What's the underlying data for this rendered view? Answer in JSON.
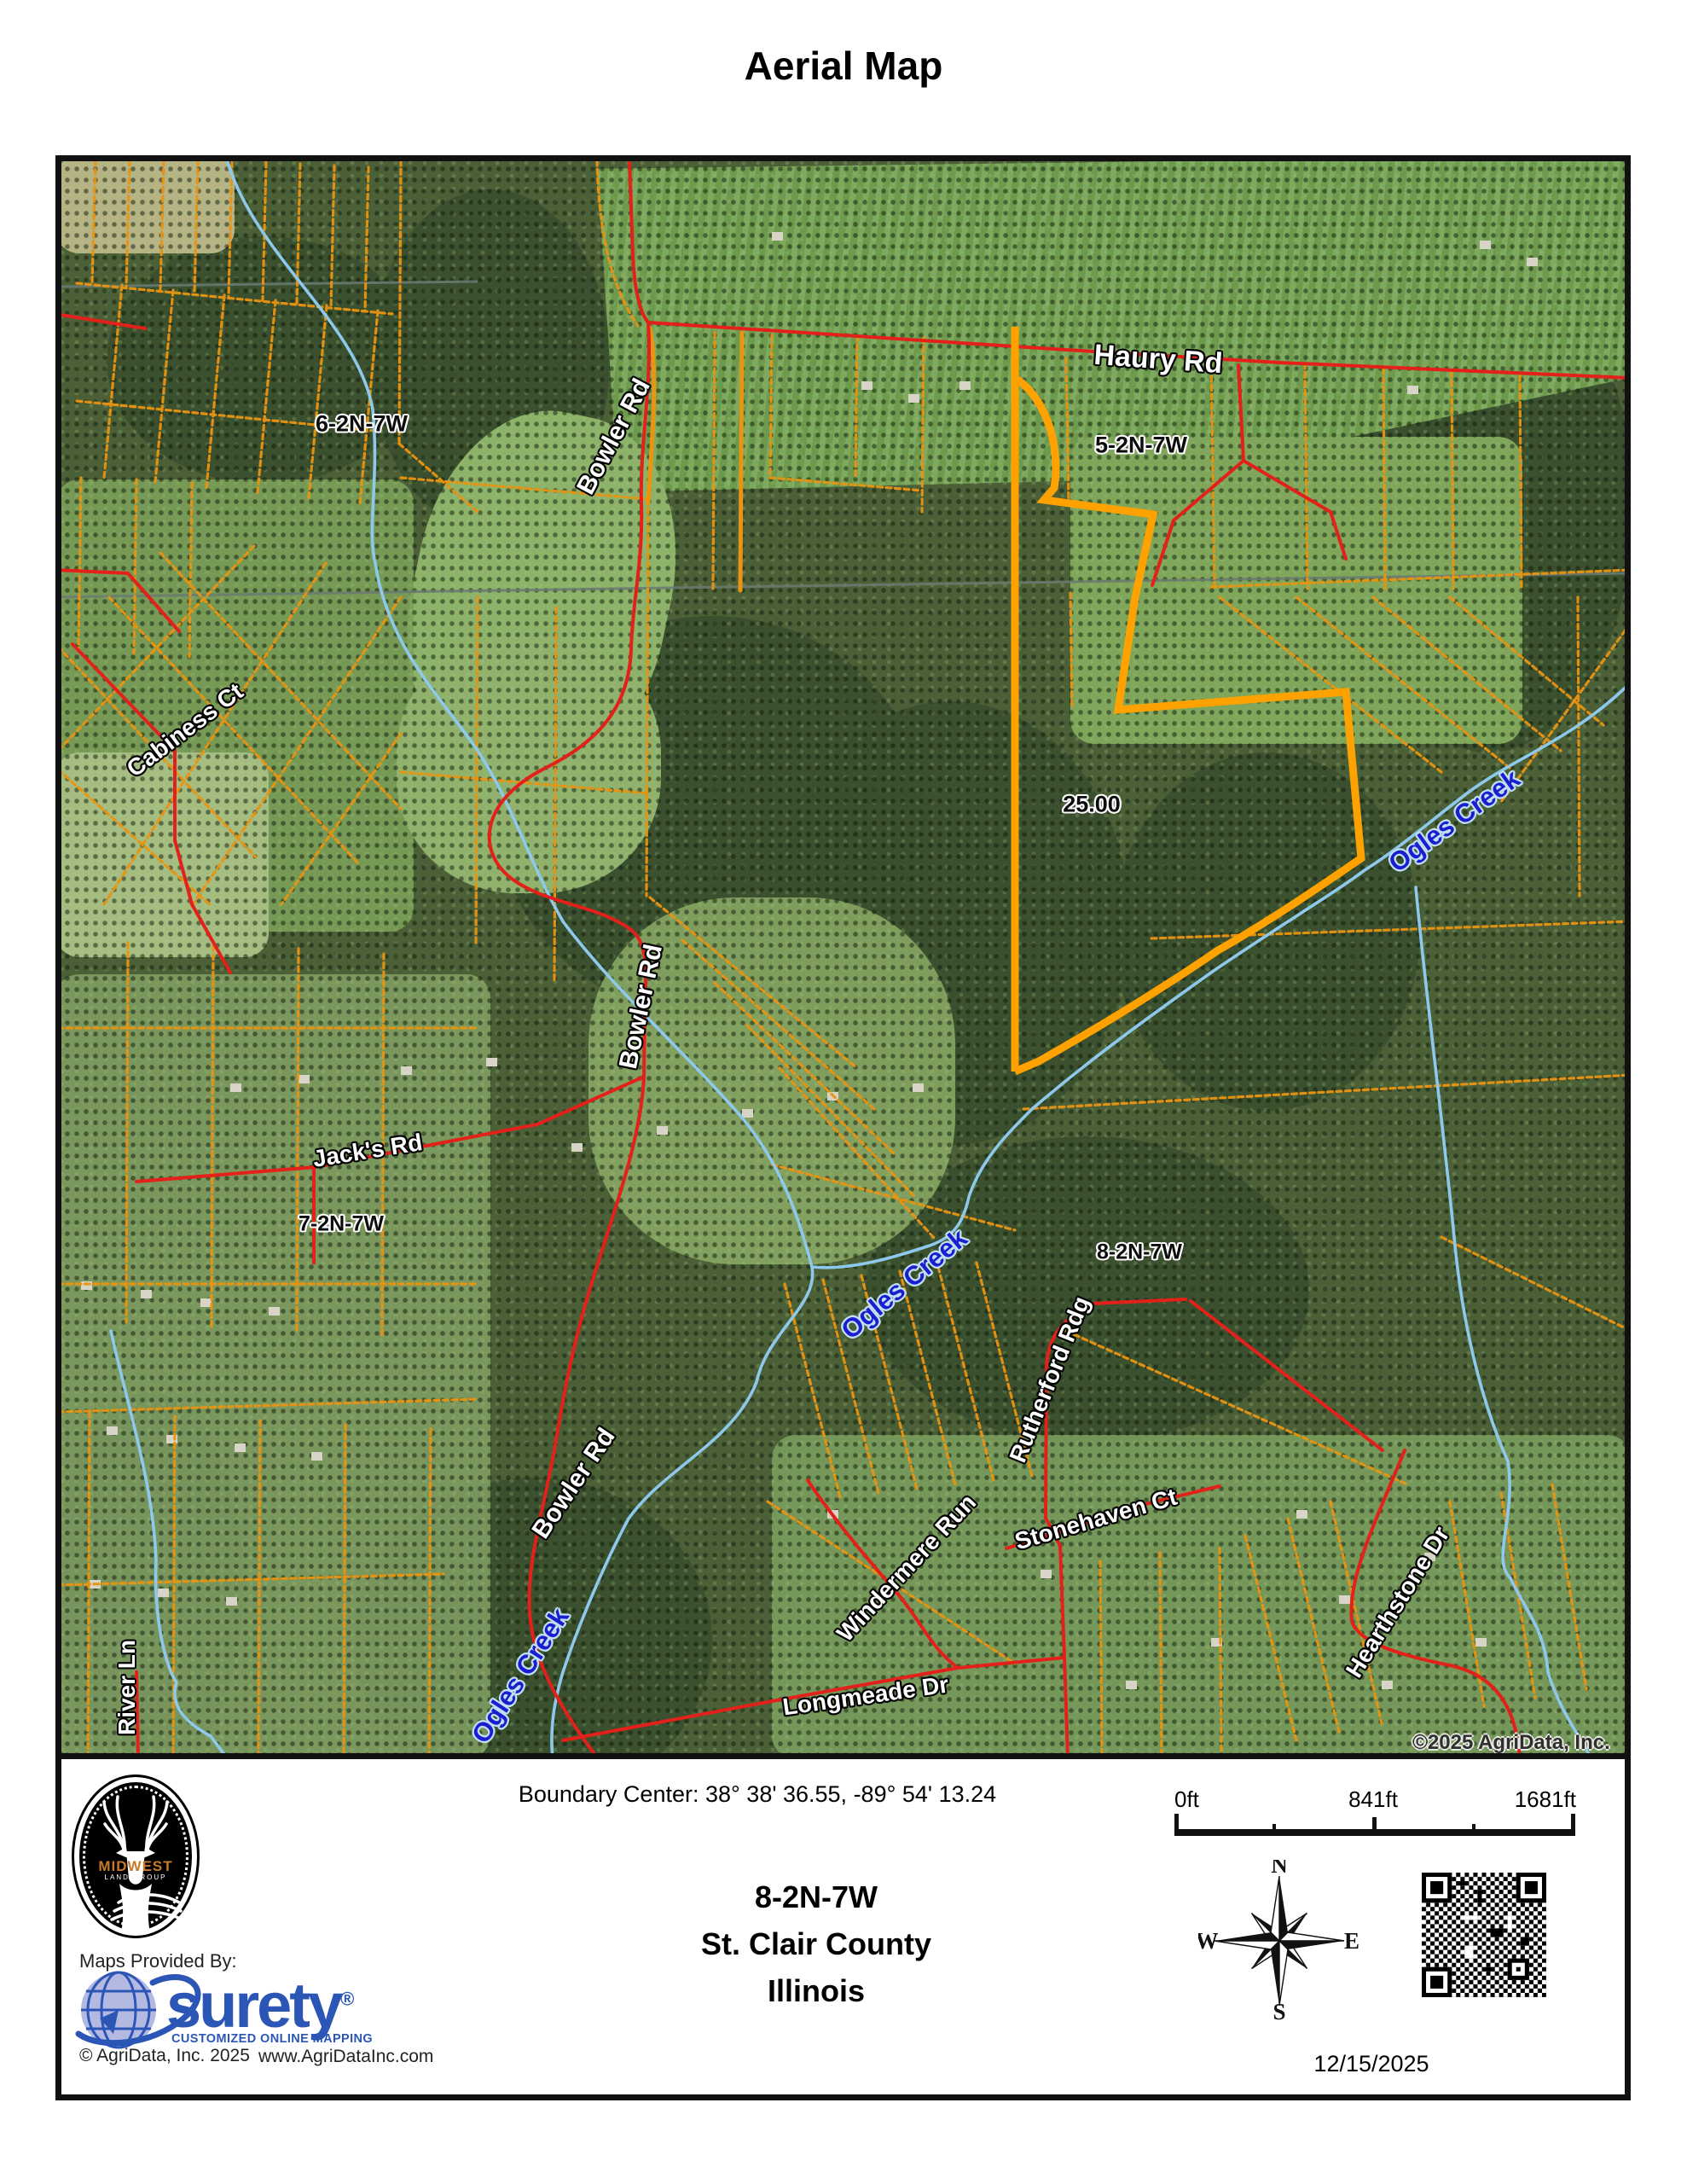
{
  "page": {
    "title": "Aerial Map"
  },
  "map": {
    "labels": {
      "haury_rd": "Haury Rd",
      "region_6": "6-2N-7W",
      "bowler_rd_top": "Bowler Rd",
      "region_5": "5-2N-7W",
      "cabiness_ct": "Cabiness Ct",
      "parcel_acreage": "25.00",
      "ogles_creek_right": "Ogles Creek",
      "bowler_rd_mid": "Bowler Rd",
      "jacks_rd": "Jack's Rd",
      "region_7": "7-2N-7W",
      "ogles_creek_mid": "Ogles Creek",
      "region_8": "8-2N-7W",
      "rutherford_rdg": "Rutherford Rdg",
      "bowler_rd_low": "Bowler Rd",
      "windermere_run": "Windermere Run",
      "stonehaven_ct": "Stonehaven Ct",
      "hearthstone_dr": "Hearthstone Dr",
      "ogles_creek_low": "Ogles Creek",
      "longmeade_dr": "Longmeade Dr",
      "river_ln": "River Ln",
      "watermark": "©2025 AgriData, Inc."
    },
    "colors": {
      "parcel_line": "#ea9410",
      "selected_parcel": "#ffa200",
      "road": "#e3211a",
      "creek": "#8ec8ea",
      "creek_label": "#1c1cd0"
    }
  },
  "footer": {
    "logo": {
      "brand_top": "MIDWEST",
      "brand_bottom": "LAND GROUP"
    },
    "boundary_center": "Boundary Center: 38° 38' 36.55,  -89° 54' 13.24",
    "scale": {
      "start": "0ft",
      "mid": "841ft",
      "end": "1681ft"
    },
    "location": {
      "trs": "8-2N-7W",
      "county": "St. Clair County",
      "state": "Illinois"
    },
    "compass": {
      "n": "N",
      "w": "W",
      "e": "E",
      "s": "S"
    },
    "provider": {
      "intro": "Maps Provided By:",
      "name": "surety",
      "reg": "®",
      "tagline": "CUSTOMIZED ONLINE MAPPING",
      "copyright": "© AgriData, Inc. 2025",
      "website": "www.AgriDataInc.com"
    },
    "date": "12/15/2025"
  }
}
